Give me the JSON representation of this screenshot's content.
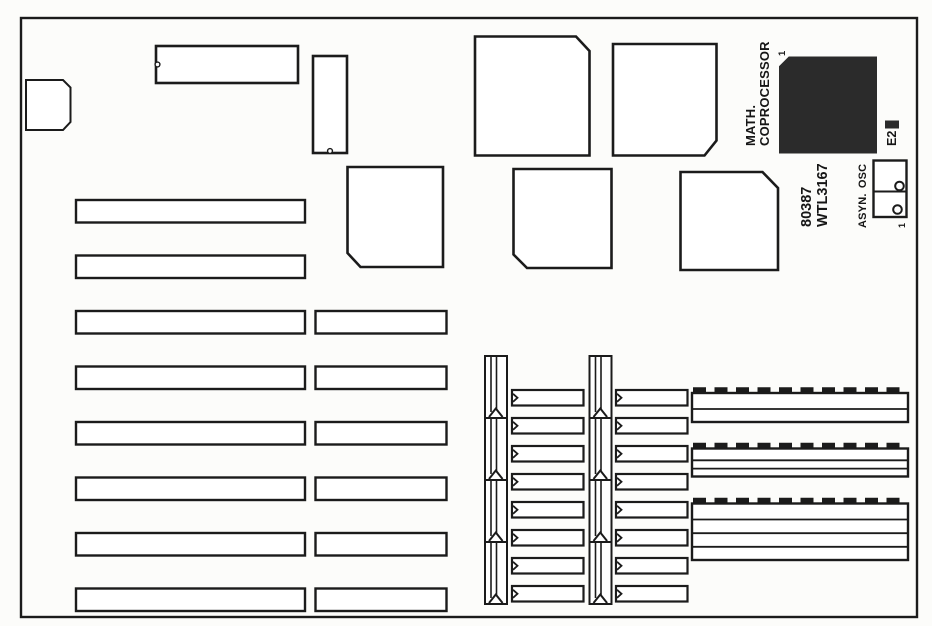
{
  "page": {
    "background": "#fcfcfa",
    "line_color": "#1b1b1b"
  },
  "board": {
    "type": "motherboard-layout-diagram",
    "labels": {
      "math_coprocessor_line1": "MATH.",
      "math_coprocessor_line2": "COPROCESSOR",
      "coprocessor_pin1": "1",
      "coprocessor_model_line1": "80387",
      "coprocessor_model_line2": "WTL3167",
      "jumper_e2": "E2",
      "asyn_osc": "ASYN. OSC",
      "osc_pin1": "1"
    },
    "colors": {
      "chip_fill": "#2b2b2b",
      "socket_fill": "#ffffff"
    },
    "components": {
      "keyboard_connector": 1,
      "dip_chips": 2,
      "square_chips_outline": 5,
      "math_coprocessor_chip": 1,
      "expansion_slots_long": 8,
      "expansion_slots_short": 6,
      "vertical_socket_strips": 2,
      "vertical_socket_segments_per_strip": 4,
      "dip_socket_columns": 2,
      "dip_sockets_per_column": 8,
      "simm_sockets": 3,
      "jumper_e2_blocks": 1,
      "oscillator_block_cells": 2
    }
  }
}
